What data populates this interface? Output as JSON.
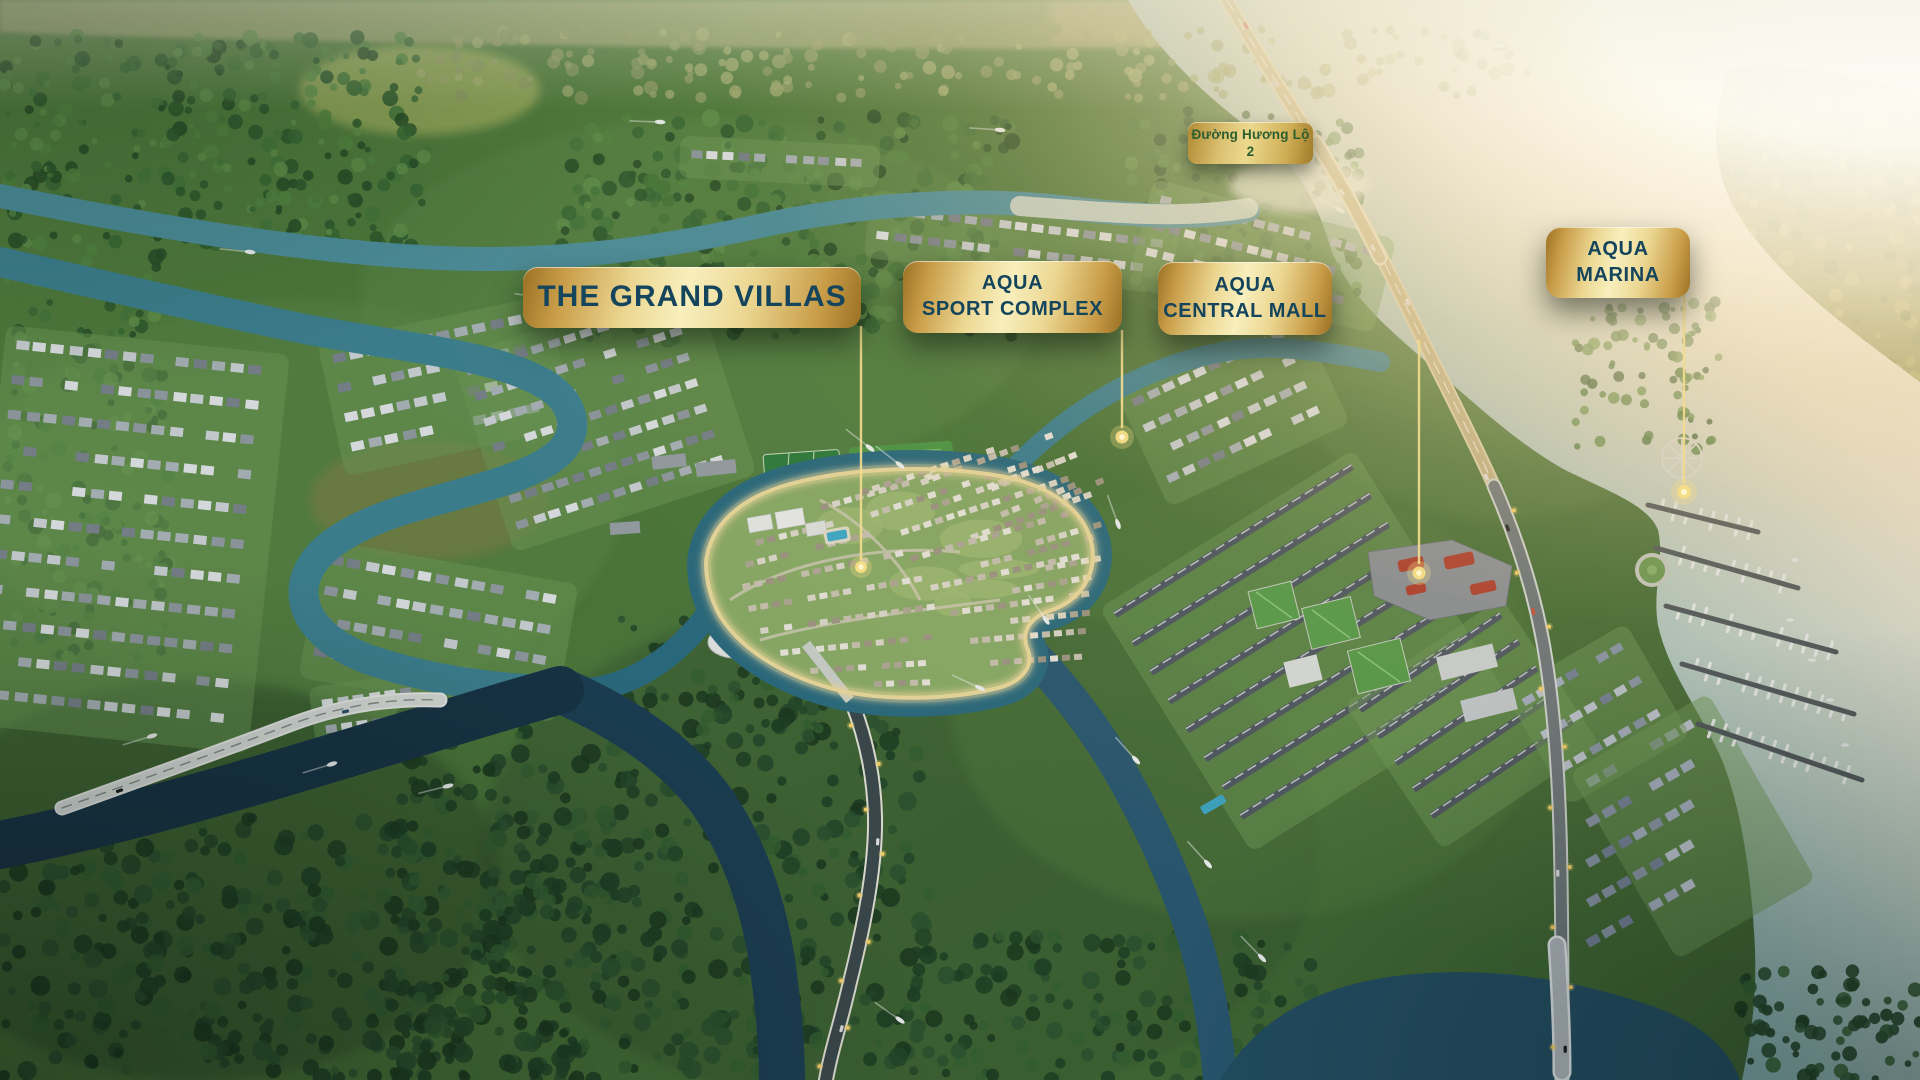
{
  "map": {
    "type": "masterplan-aerial-render",
    "callouts": {
      "grand_villas": {
        "label": "THE GRAND VILLAS"
      },
      "sport_complex": {
        "line1": "AQUA",
        "line2": "SPORT COMPLEX"
      },
      "central_mall": {
        "line1": "AQUA",
        "line2": "CENTRAL MALL"
      },
      "marina": {
        "line1": "AQUA",
        "line2": "MARINA"
      },
      "road": {
        "label": "Đường Hương Lộ 2"
      }
    },
    "markers": {
      "grand_villas": "location-dot",
      "sport_complex": "location-dot",
      "central_mall": "location-dot",
      "marina": "location-dot"
    }
  },
  "colors": {
    "banner_gold_edge": "#9a7024",
    "banner_gold_deep": "#c89c47",
    "banner_gold_soft": "#ecd792",
    "banner_gold_light": "#f8efbd",
    "label_navy": "#14455c",
    "label_green": "#2d5e2f",
    "leader_gold": "#f3dc8f",
    "marker_dot": "#f6dd86",
    "water_teal": "#3f8494",
    "water_dark": "#1d4056",
    "river_glare": "#fdf7e9",
    "sun_glare": "#ffffff"
  }
}
